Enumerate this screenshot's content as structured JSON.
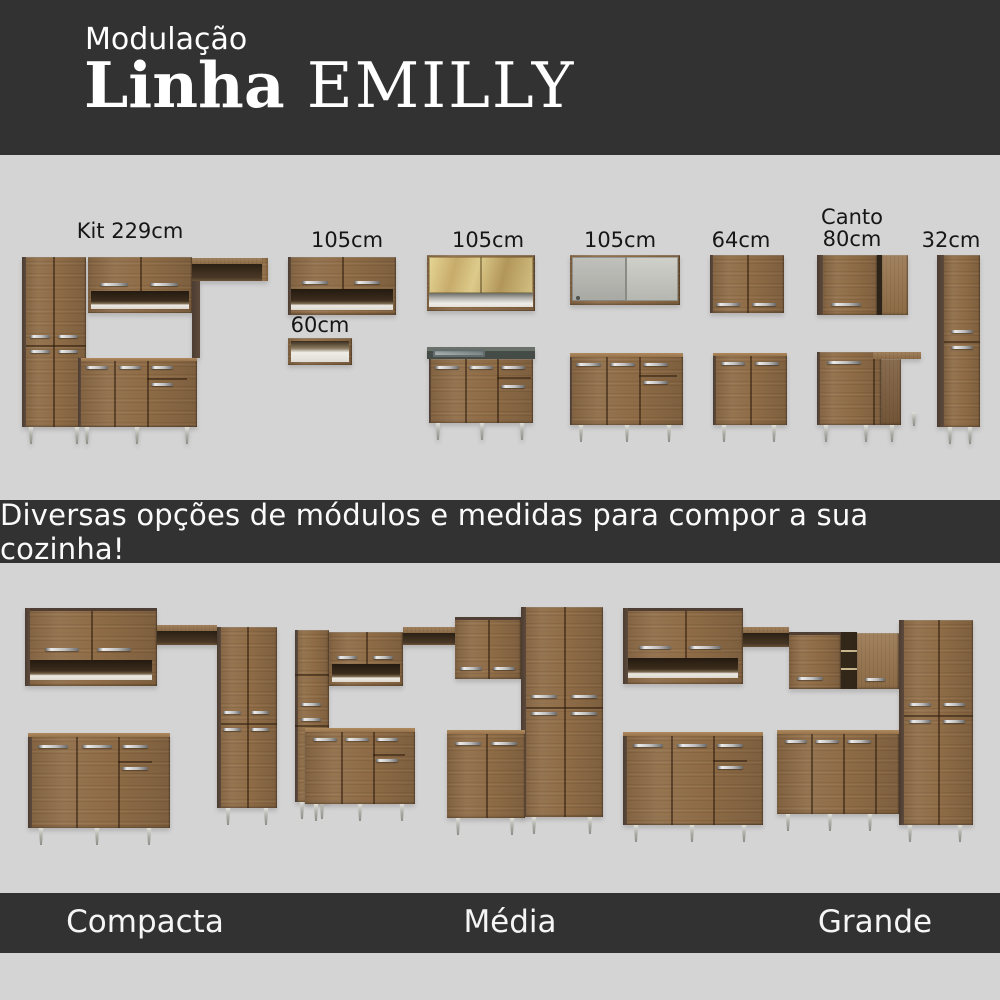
{
  "header": {
    "kicker": "Modulação",
    "title_primary": "Linha",
    "title_secondary": "EMILLY"
  },
  "modules": {
    "items": [
      {
        "id": "kit-229",
        "label": "Kit 229cm"
      },
      {
        "id": "wall-105-niche",
        "label": "105cm"
      },
      {
        "id": "wall-105-glass",
        "label": "105cm"
      },
      {
        "id": "wall-105-sliding",
        "label": "105cm"
      },
      {
        "id": "wall-64",
        "label": "64cm"
      },
      {
        "id": "wall-canto-80",
        "label": "Canto\n80cm"
      },
      {
        "id": "tall-32",
        "label": "32cm"
      },
      {
        "id": "niche-60",
        "label": "60cm"
      }
    ]
  },
  "banner": {
    "text": "Diversas opções de módulos e medidas para compor a sua cozinha!"
  },
  "kitchens": {
    "items": [
      {
        "id": "compacta",
        "label": "Compacta"
      },
      {
        "id": "media",
        "label": "Média"
      },
      {
        "id": "grande",
        "label": "Grande"
      }
    ]
  },
  "colors": {
    "band_dark": "#323232",
    "background": "#d4d4d4",
    "wood": "#8f6c46",
    "wood_dark_side": "#54433a",
    "handle_metal": "#c9c9c9",
    "counter_dark": "#454b47",
    "text_light": "#f5f5f5",
    "text_dark": "#161616"
  }
}
